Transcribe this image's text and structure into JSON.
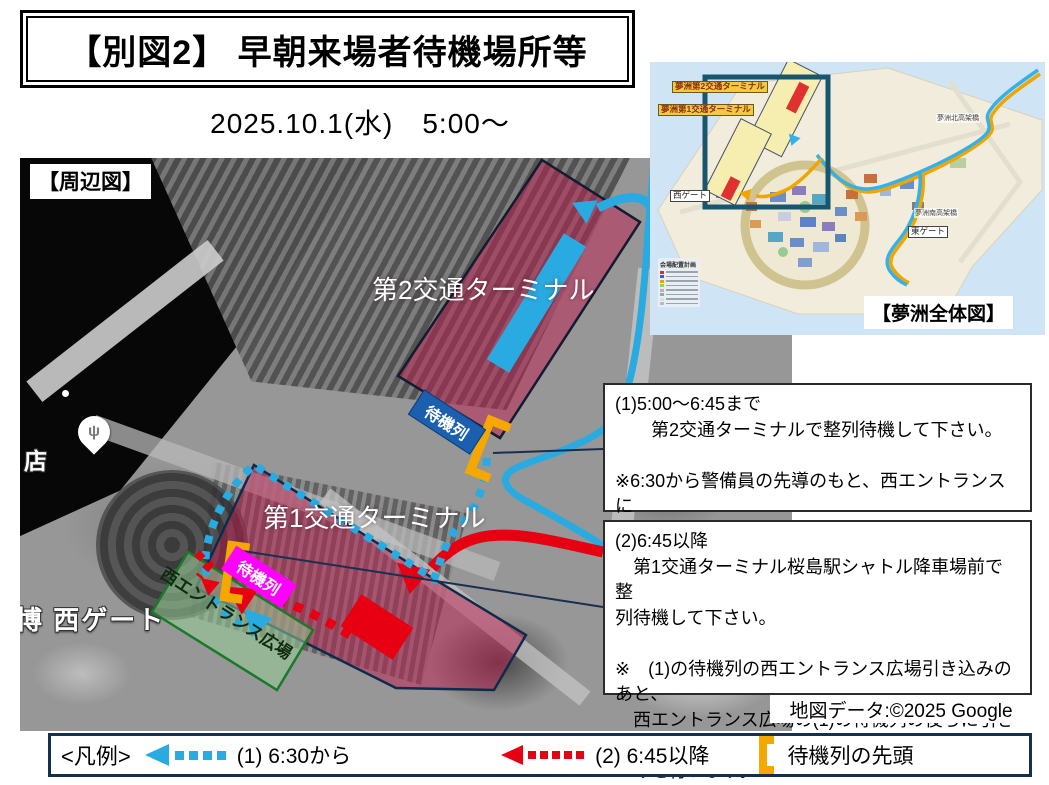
{
  "title": "【別図2】 早朝来場者待機場所等",
  "datetime": "2025.10.1(水)　5:00～",
  "map": {
    "caption": "【周辺図】",
    "terminal2": "第2交通ターミナル",
    "terminal1": "第1交通ターミナル",
    "queue_label_t2": "待機列",
    "queue_label_t1": "待機列",
    "west_entrance_plaza": "西エントランス広場",
    "shop_label": "店",
    "west_gate_label": "博 西ゲート",
    "poi_icon": "restaurant-pin",
    "attribution": "地図データ:©2025 Google"
  },
  "inset": {
    "caption": "【夢洲全体図】",
    "terminal2_label": "夢洲第2交通ターミナル",
    "terminal1_label": "夢洲第1交通ターミナル",
    "west_gate": "西ゲート",
    "east_gate": "東ゲート",
    "north_bridge": "夢洲北高架橋",
    "south_bridge": "夢洲南高架橋",
    "plan_title": "会場配置計画"
  },
  "notes": {
    "note1": "(1)5:00～6:45まで\n　　第2交通ターミナルで整列待機して下さい。\n\n※6:30から警備員の先導のもと、西エントランスに\n　引き込みを行います。",
    "note2": "(2)6:45以降\n　第1交通ターミナル桜島駅シャトル降車場前で整\n 列待機して下さい。\n\n※　(1)の待機列の西エントランス広場引き込みのあと、\n　西エントランス広場の(1)の待機列の後ろに引き込\n　みを行います。"
  },
  "legend": {
    "title": "<凡例>",
    "item1": "(1) 6:30から",
    "item2": "(2)  6:45以降",
    "item3": "待機列の先頭"
  },
  "colors": {
    "route_blue": "#29ABE2",
    "route_red": "#E60012",
    "queue_head_orange": "#F5A800",
    "queue_label_magenta": "#FF00FF",
    "queue_label_blue": "#1B5FAE",
    "terminal_fill_pink": "rgba(190,30,80,0.5)",
    "plaza_fill_green": "rgba(150,205,150,0.55)"
  }
}
